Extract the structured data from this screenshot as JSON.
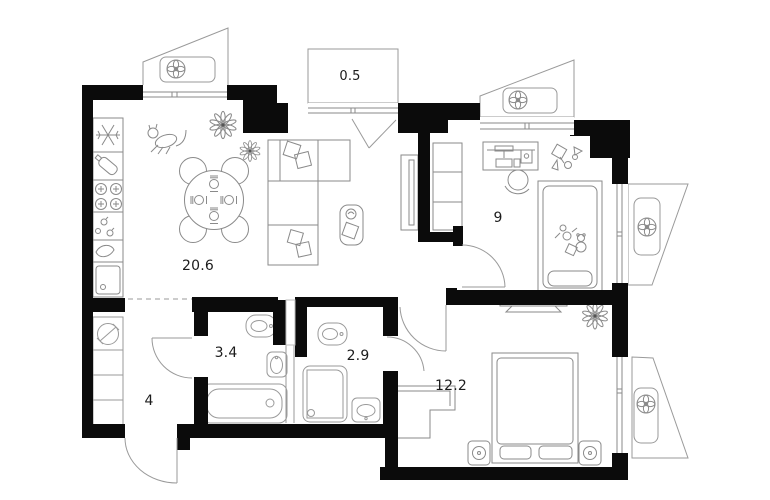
{
  "plan": {
    "type": "apartment-floor-plan",
    "background": "#ffffff",
    "colors": {
      "wall": "#0b0b0b",
      "furniture_line": "#888888",
      "label": "#1c1c1c"
    },
    "rooms": [
      {
        "id": "living-kitchen",
        "label": "20.6"
      },
      {
        "id": "balcony",
        "label": "0.5"
      },
      {
        "id": "kids-bedroom",
        "label": "9"
      },
      {
        "id": "bathroom",
        "label": "3.4"
      },
      {
        "id": "shower-room",
        "label": "2.9"
      },
      {
        "id": "master-bedroom",
        "label": "12.2"
      },
      {
        "id": "hallway",
        "label": "4"
      }
    ],
    "icons": [
      "ac-fan-icon",
      "snowflake-fridge-icon",
      "bottle-icon",
      "stove-burners-icon",
      "drops-icon",
      "drain-icon",
      "kitchen-sink-icon",
      "electric-panel-icon",
      "dining-table-icon",
      "chair-icon",
      "plate-setting-icon",
      "cat-icon",
      "flower-plant-icon",
      "sofa-icon",
      "cushion-icon",
      "side-table-icon",
      "tv-console-icon",
      "wardrobe-icon",
      "desk-icon",
      "desk-chair-icon",
      "toys-icon",
      "single-bed-icon",
      "double-bed-icon",
      "nightstand-icon",
      "wall-tv-icon",
      "toilet-icon",
      "washbasin-icon",
      "bathtub-icon",
      "shower-cabin-icon",
      "door-swing-icon",
      "window-icon"
    ]
  }
}
